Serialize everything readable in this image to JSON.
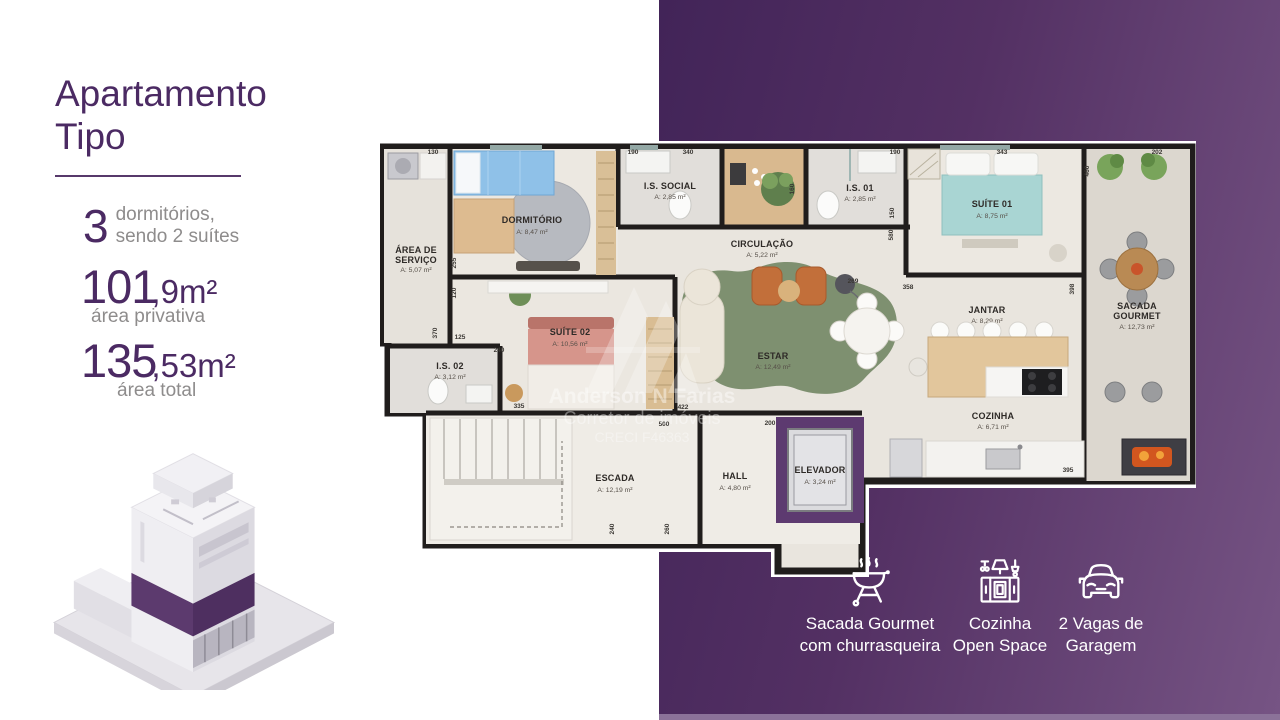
{
  "slide": {
    "left_panel": {
      "title_line1": "Apartamento",
      "title_line2": "Tipo",
      "stats": [
        {
          "value": "3",
          "label_line1": "dormitórios,",
          "label_line2": "sendo 2 suítes"
        },
        {
          "value": "101",
          "unit": ",9m²",
          "label": "área privativa"
        },
        {
          "value": "135",
          "unit": ",53m²",
          "label": "área total"
        }
      ]
    },
    "floor_plan": {
      "rooms": {
        "area_servico": {
          "name_line1": "ÁREA DE",
          "name_line2": "SERVIÇO",
          "area": "A: 5,07 m²"
        },
        "dormitorio": {
          "name": "DORMITÓRIO",
          "area": "A: 8,47 m²"
        },
        "is_social": {
          "name": "I.S. SOCIAL",
          "area": "A: 2,85 m²"
        },
        "is_01": {
          "name": "I.S. 01",
          "area": "A: 2,85 m²"
        },
        "suite_01": {
          "name": "SUÍTE 01",
          "area": "A: 8,75 m²"
        },
        "sacada_gourmet": {
          "name_line1": "SACADA",
          "name_line2": "GOURMET",
          "area": "A: 12,73 m²"
        },
        "circulacao": {
          "name": "CIRCULAÇÃO",
          "area": "A: 5,22 m²"
        },
        "estar": {
          "name": "ESTAR",
          "area": "A: 12,49 m²"
        },
        "jantar": {
          "name": "JANTAR",
          "area": "A: 8,29 m²"
        },
        "cozinha": {
          "name": "COZINHA",
          "area": "A: 6,71 m²"
        },
        "suite_02": {
          "name": "SUÍTE 02",
          "area": "A: 10,56 m²"
        },
        "is_02": {
          "name": "I.S. 02",
          "area": "A: 3,12 m²"
        },
        "escada": {
          "name": "ESCADA",
          "area": "A: 12,19 m²"
        },
        "hall": {
          "name": "HALL",
          "area": "A: 4,80 m²"
        },
        "elevador": {
          "name": "ELEVADOR",
          "area": "A: 3,24 m²"
        }
      },
      "dims": [
        "130",
        "190",
        "340",
        "160",
        "190",
        "343",
        "202",
        "460",
        "150",
        "580",
        "358",
        "398",
        "269",
        "255",
        "120",
        "370",
        "125",
        "240",
        "335",
        "422",
        "500",
        "200",
        "260",
        "240",
        "395"
      ],
      "watermark": {
        "line1": "Anderson N Farias",
        "line2": "Corretor de imóveis",
        "line3": "CRECI F46363"
      }
    },
    "features": [
      {
        "icon": "barbecue-grill-icon",
        "label_line1": "Sacada Gourmet",
        "label_line2": "com churrasqueira"
      },
      {
        "icon": "kitchen-hood-icon",
        "label_line1": "Cozinha",
        "label_line2": "Open Space"
      },
      {
        "icon": "car-icon",
        "label_line1": "2 Vagas de",
        "label_line2": "Garagem"
      }
    ],
    "colors": {
      "accent_purple": "#4B2A63",
      "panel_gradient_dark": "#422458",
      "panel_gradient_light": "#765484",
      "building_band_purple": "#5C3A6E",
      "footer_bar": "#8B7299",
      "text_gray": "#8E8C8C"
    }
  }
}
